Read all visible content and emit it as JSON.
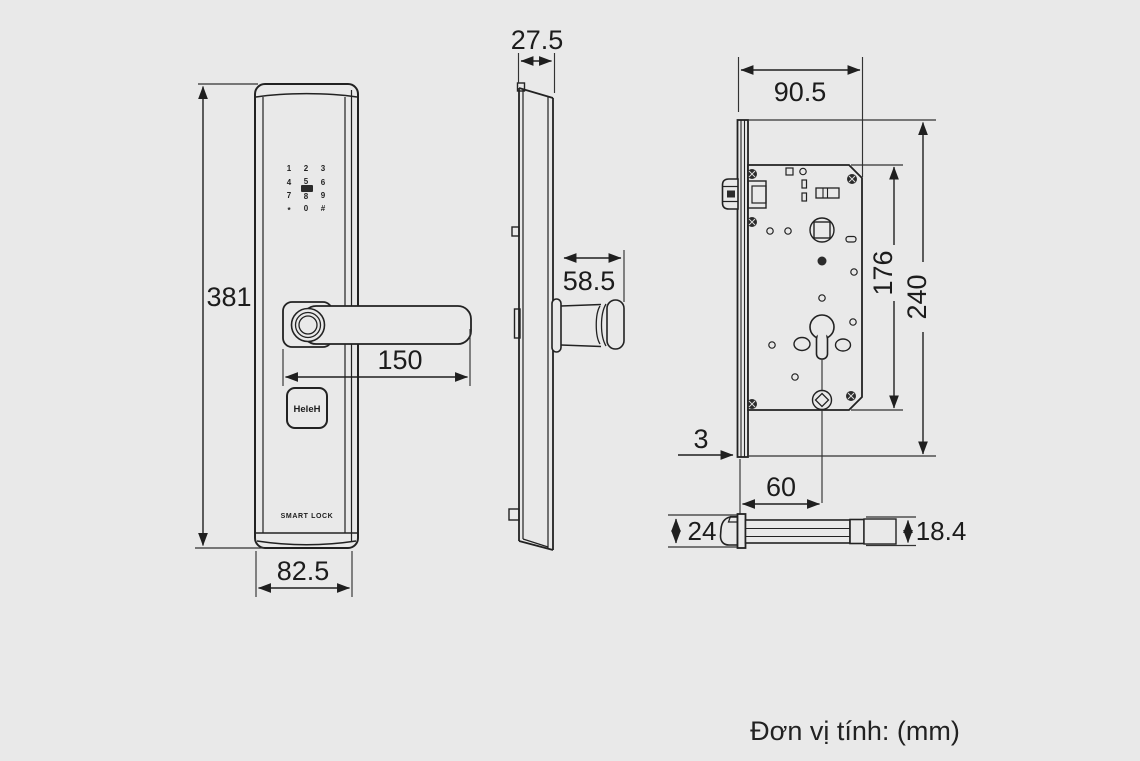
{
  "canvas": {
    "background": "#e9e9e9",
    "line_color": "#1f1f1f",
    "text_color": "#1c1c1c"
  },
  "unit_note": "Đơn vị tính: (mm)",
  "front_view": {
    "dims": {
      "height": "381",
      "handle_length": "150",
      "width": "82.5"
    },
    "keypad": {
      "keys": [
        "1",
        "2",
        "3",
        "4",
        "5",
        "6",
        "7",
        "8",
        "9",
        "*",
        "0",
        "#"
      ]
    },
    "logo_text": "HeleH",
    "brand_text": "SMART LOCK"
  },
  "side_view": {
    "dims": {
      "thickness": "27.5",
      "handle_depth": "58.5"
    }
  },
  "mortise_view": {
    "dims": {
      "width": "90.5",
      "body_height": "176",
      "faceplate_height": "240",
      "faceplate_thickness": "3",
      "backset": "60"
    }
  },
  "latch_view": {
    "dims": {
      "faceplate_height": "24",
      "bolt_height": "18.4"
    }
  }
}
